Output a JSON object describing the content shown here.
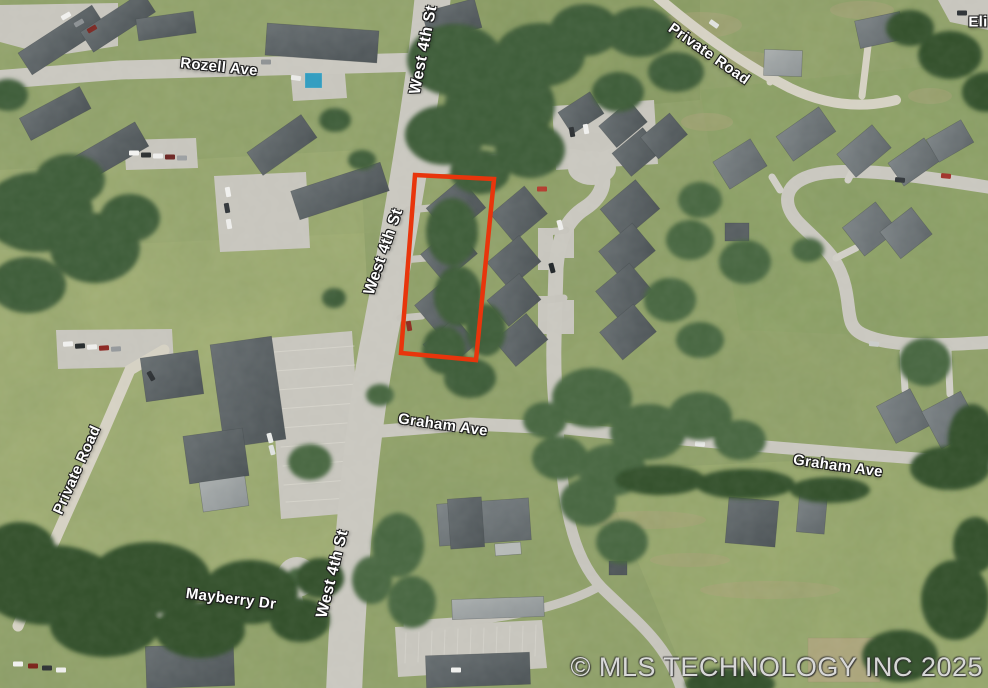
{
  "map": {
    "view": "aerial-satellite",
    "labels": [
      {
        "id": "west-4th-st-top",
        "text": "West 4th St"
      },
      {
        "id": "rozell-ave",
        "text": "Rozell Ave"
      },
      {
        "id": "private-road-ne",
        "text": "Private Road"
      },
      {
        "id": "eli-partial",
        "text": "Eli"
      },
      {
        "id": "west-4th-st-mid",
        "text": "West 4th St"
      },
      {
        "id": "graham-ave-west",
        "text": "Graham Ave"
      },
      {
        "id": "graham-ave-east",
        "text": "Graham Ave"
      },
      {
        "id": "private-road-west",
        "text": "Private Road"
      },
      {
        "id": "mayberry-dr",
        "text": "Mayberry Dr"
      },
      {
        "id": "west-4th-st-bottom",
        "text": "West 4th St"
      }
    ],
    "copyright": "© MLS TECHNOLOGY INC 2025",
    "highlight": {
      "points": "415,175 494,179 476,360 401,353",
      "color": "#e8350c"
    },
    "colors": {
      "grass": "#93a36a",
      "field_light": "#a4b276",
      "trees": "#3e5b37",
      "road": "#c9c7bf",
      "road_private": "#d5d1c3",
      "building_dark": "#565d60",
      "building_mid": "#6d7477",
      "building_light": "#9aa0a0",
      "pool": "#2e9bbf",
      "label_text": "#ffffff",
      "watermark": "#eeeeee"
    }
  }
}
